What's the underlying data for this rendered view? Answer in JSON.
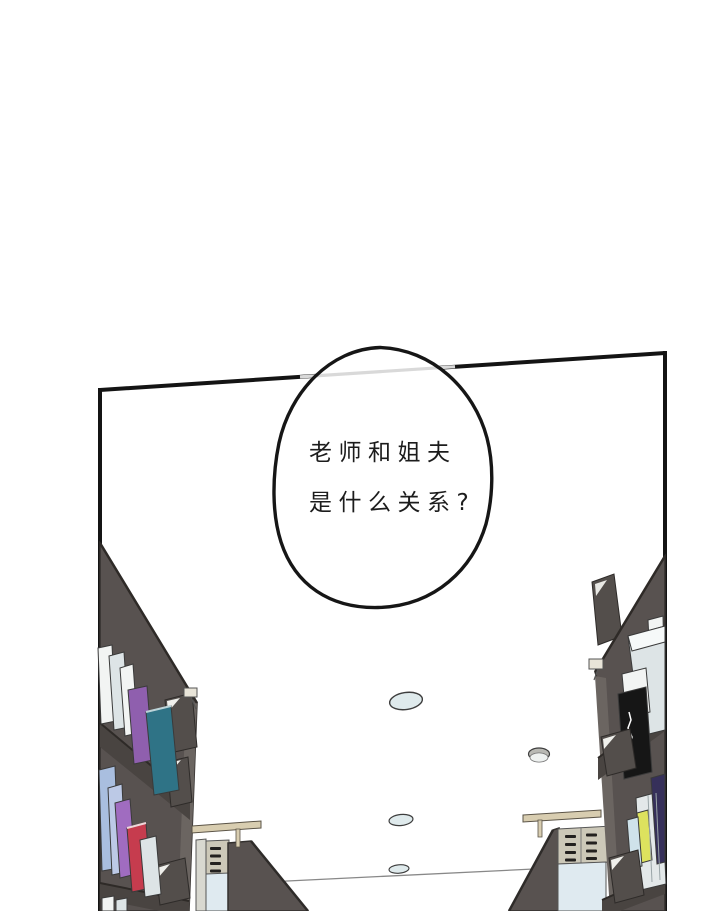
{
  "panel": {
    "speech_bubble": {
      "line1": "老师和姐夫",
      "line2": "是什么关系?"
    }
  },
  "objects": [
    "speech-bubble",
    "panel-border",
    "bookshelf-left",
    "bookshelf-right",
    "book-cart-left",
    "book-cart-right",
    "reading-table-left",
    "reading-table-right",
    "ceiling-light",
    "smoke-detector",
    "wall-lamp",
    "bookend",
    "book-spine"
  ],
  "colors": {
    "panel_border": "#141414",
    "shelf": "#585250",
    "shelf_dark": "#494441",
    "shelf_side": "#6b6561",
    "shelf_edge": "#2e2a27",
    "book_white": "#f2f4f3",
    "book_gray": "#dde4e6",
    "book_purple": "#8f5fae",
    "book_violet": "#a06cc0",
    "book_teal": "#2f7386",
    "book_lavender": "#a9bedf",
    "book_lavender2": "#bcc9e6",
    "book_red": "#c63c4e",
    "book_navy": "#36305a",
    "book_yellow": "#dde25e",
    "book_lightblue": "#cfe2ea",
    "book_black": "#161616",
    "light_fill": "#dfeaec",
    "cart_beige": "#ccc8b8",
    "cart_blue": "#dfeaf0",
    "cart_strip": "#d8d8d0",
    "railing": "#d8cdb0",
    "bubble_fill": "#ffffff",
    "bubble_stroke": "#161616",
    "border_through_bubble": "#d9d9d9",
    "text": "#1c1c1c",
    "plate": "#534e4b"
  }
}
